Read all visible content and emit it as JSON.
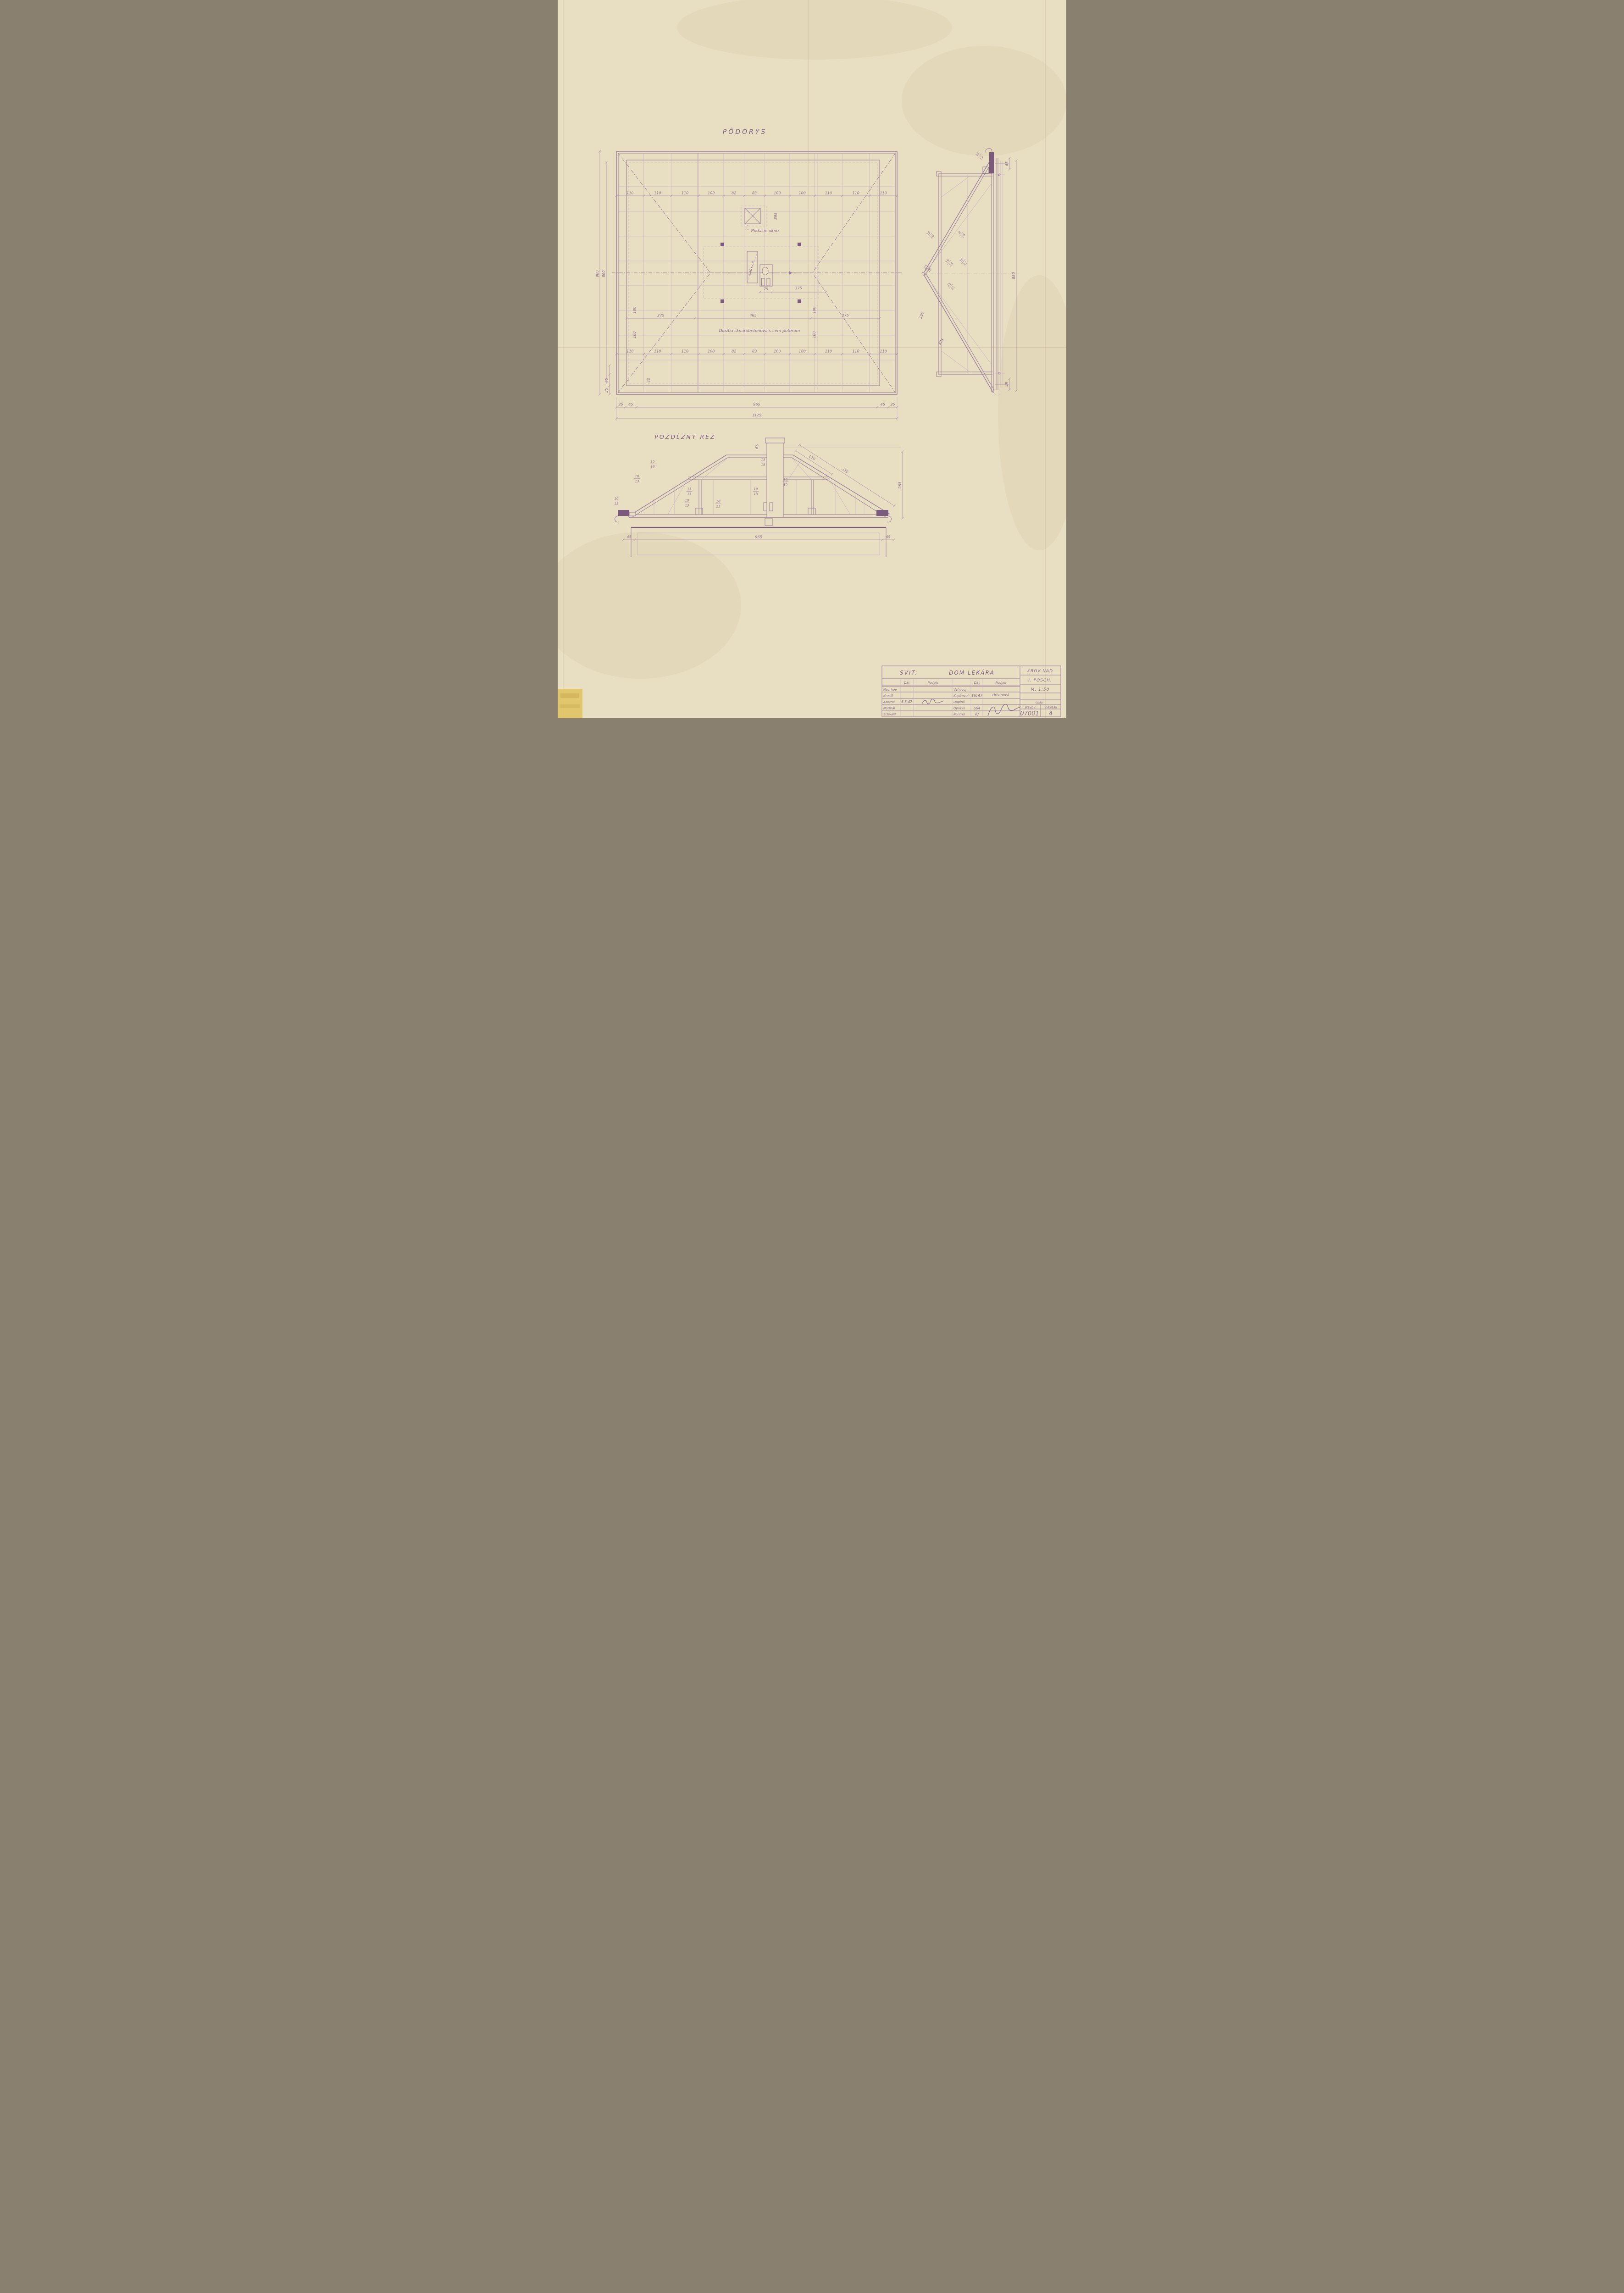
{
  "sheet": {
    "paper_color": "#e8dec2",
    "ink_color": "#9a7b9b",
    "ink_dark": "#7b5a7e",
    "text_color": "#8a6a8c"
  },
  "plan": {
    "title": "PÔDORYS",
    "dims_top": [
      "110",
      "110",
      "110",
      "100",
      "82",
      "83",
      "100",
      "100",
      "110",
      "110",
      "110"
    ],
    "dims_bottom": [
      "110",
      "110",
      "110",
      "100",
      "82",
      "83",
      "100",
      "100",
      "110",
      "110",
      "110"
    ],
    "dims_mid": [
      "275",
      "465",
      "275"
    ],
    "chain_bottom": [
      "35",
      "45",
      "965",
      "45",
      "35"
    ],
    "total_width": "1125",
    "height_outer": "980",
    "height_inner": "890",
    "corner_v_45": "45",
    "corner_v_35": "35",
    "dim_40": "40",
    "spacing_100": "100",
    "chimney_width": "75",
    "dim_375": "375",
    "dim_395": "395",
    "note_hatch": "2.40×1.0",
    "label_padacie": "Podacie okno",
    "label_dlazba": "Dlažba škvárobetonová s cem poterom"
  },
  "side": {
    "fr1": "15/18",
    "fr2": "8/18",
    "fr3": "10/13",
    "fr4": "18/21",
    "fr5": "15/15",
    "fr6": "15/18",
    "fr7": "10/13",
    "dim_height": "880",
    "dim_45_top": "45",
    "dim_45_bottom": "45",
    "dim_150": "150",
    "dim_375": "375"
  },
  "section": {
    "title": "POZDĹŽNY REZ",
    "fr1": "15/18",
    "fr2": "10/13",
    "fr3": "10/13",
    "fr4": "15/15",
    "fr5": "10/13",
    "fr6": "18/21",
    "fr7": "10/13",
    "fr8": "15/18",
    "fr9": "15/15",
    "dim_120": "120",
    "dim_330": "330",
    "dim_265": "265",
    "dim_65": "65",
    "chain_bottom": [
      "45",
      "965",
      "45"
    ]
  },
  "titleblock": {
    "location": "SVIT:",
    "project": "DOM LEKÁRA",
    "col_date": "Dát",
    "col_sign": "Podpis",
    "rows_left": [
      "Navrhov",
      "Kreslil",
      "Kontrol",
      "Normál",
      "Schválil"
    ],
    "rows_right": [
      "Vyhovuj",
      "Kopíroval:",
      "Doplnil",
      "Opravil",
      "Kontrol"
    ],
    "entry_kontrol_date": "6.3.47",
    "entry_kopiroval_num": "16147",
    "entry_kopiroval_sign": "Urbanová",
    "entry_opravil_num": "664",
    "entry_kontrol2_num": "47",
    "drawing_title_1": "KROV NAD",
    "drawing_title_2": "I. POSCH.",
    "scale": "M. 1:50",
    "num_header": "číslo",
    "num_col1": "stavby",
    "num_col2": "výkresu",
    "num_stavby": "07001",
    "num_vykresu": "4"
  }
}
